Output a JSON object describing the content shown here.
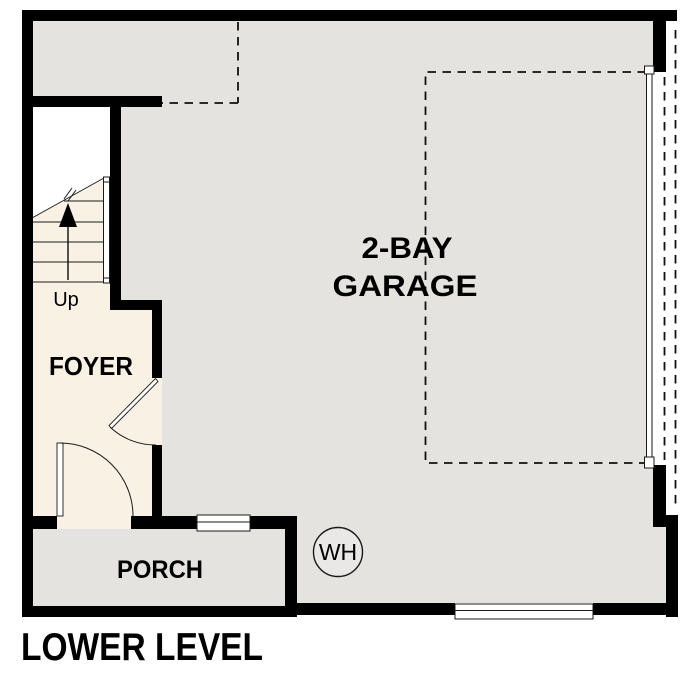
{
  "plan": {
    "title": "LOWER LEVEL",
    "rooms": {
      "garage": {
        "label_line1": "2-BAY",
        "label_line2": "GARAGE"
      },
      "foyer": {
        "label": "FOYER"
      },
      "porch": {
        "label": "PORCH"
      }
    },
    "stairs": {
      "direction_label": "Up"
    },
    "fixtures": {
      "water_heater_label": "WH"
    },
    "colors": {
      "wall": "#000000",
      "garage_floor": "#e4e3e0",
      "foyer_floor": "#f8f1e4",
      "porch_floor": "#e4e3e0",
      "stairwell_void": "#ffffff",
      "fixture_fill": "#e9e8e6",
      "line": "#1a1a1a"
    }
  }
}
